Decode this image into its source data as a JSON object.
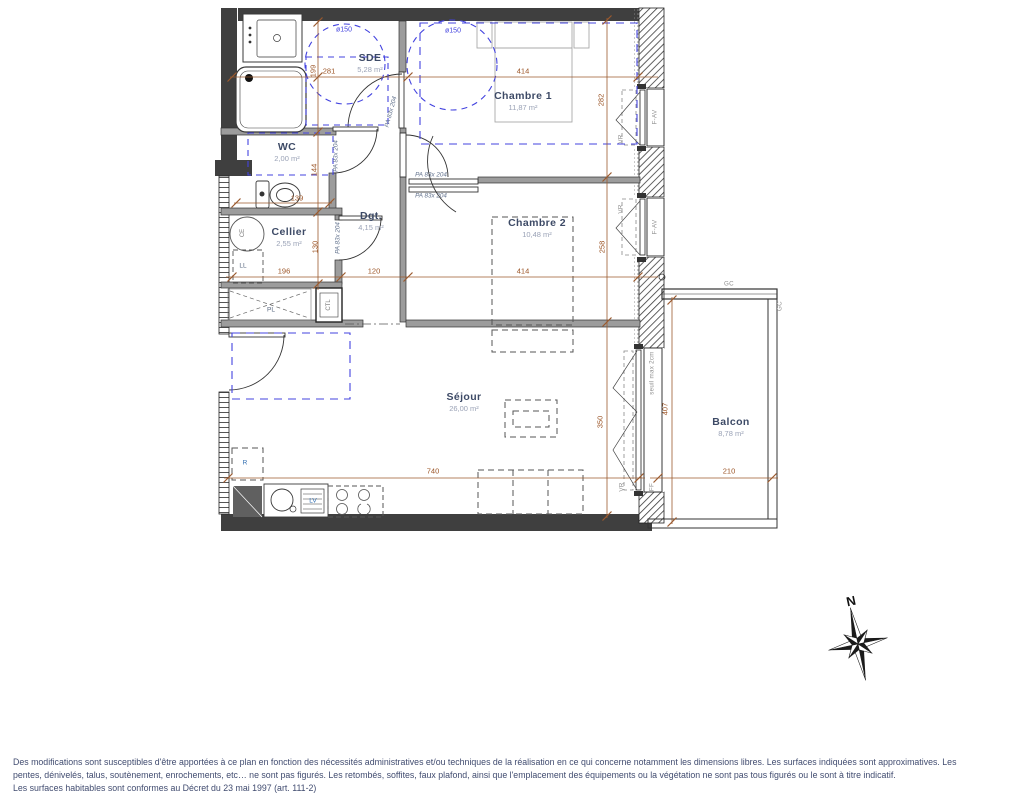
{
  "rooms": {
    "sde": {
      "name": "SDE",
      "area": "5,28 m²"
    },
    "chambre1": {
      "name": "Chambre 1",
      "area": "11,87 m²"
    },
    "wc": {
      "name": "WC",
      "area": "2,00 m²"
    },
    "dgt": {
      "name": "Dgt.",
      "area": "4,15 m²"
    },
    "cellier": {
      "name": "Cellier",
      "area": "2,55 m²"
    },
    "chambre2": {
      "name": "Chambre 2",
      "area": "10,48 m²"
    },
    "sejour": {
      "name": "Séjour",
      "area": "26,00 m²"
    },
    "balcon": {
      "name": "Balcon",
      "area": "8,78 m²"
    }
  },
  "dims": {
    "sde_h": "199",
    "sde_w": "281",
    "c1_w": "414",
    "c1_h": "282",
    "wc_h": "144",
    "wc_w": "139",
    "cellier_h": "130",
    "cellier_w": "196",
    "dgt_w": "120",
    "c2_w": "414",
    "c2_h": "258",
    "sejour_h": "350",
    "sejour_w": "740",
    "balcon_h": "407",
    "balcon_w": "210"
  },
  "doors": {
    "size_label": "PA 83x 204"
  },
  "windows": {
    "vr": "VR",
    "f_av": "F-AV",
    "ff": "FF",
    "gc": "GC",
    "seuil": "seuil max 2cm",
    "turning_circle": "ø150"
  },
  "equipment": {
    "ce": "CE",
    "ll": "LL",
    "pl": "PL",
    "ctl": "CTL",
    "r": "R",
    "lv": "LV"
  },
  "compass": {
    "north": "N"
  },
  "disclaimer": {
    "line1": "Des modifications sont susceptibles d'être apportées à ce plan en fonction des nécessités administratives et/ou techniques de la réalisation en ce qui concerne notamment les dimensions libres. Les surfaces indiquées sont approximatives. Les",
    "line2": "pentes, dénivelés, talus, soutènement, enrochements, etc… ne sont pas figurés. Les retombés, soffites, faux plafond, ainsi que l'emplacement des équipements ou la végétation ne sont pas tous figurés ou le sont à titre indicatif.",
    "line3": "Les surfaces habitables sont conformes au Décret du 23 mai 1997 (art. 111-2)"
  },
  "colors": {
    "wall": "#3f3f3f",
    "partition": "#9c9c9c",
    "dimension": "#9b5426",
    "accessibility": "#4343df",
    "room_text": "#3d4a66",
    "disclaimer_text": "#414c70"
  }
}
